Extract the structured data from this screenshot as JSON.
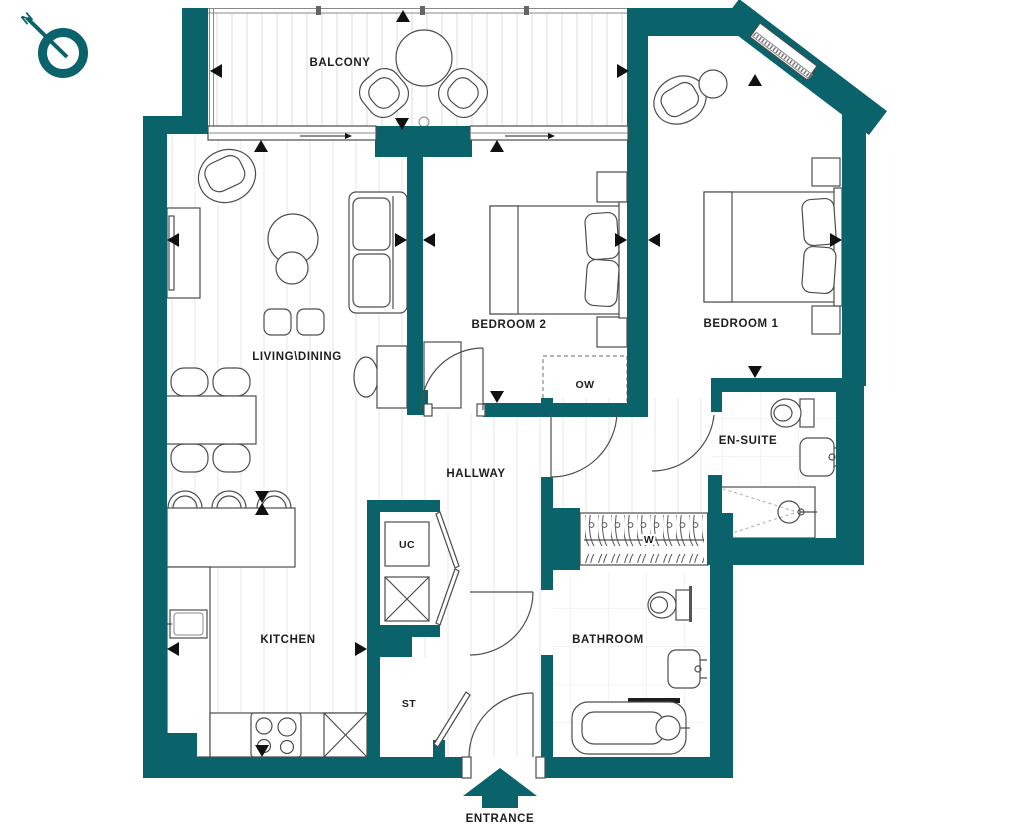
{
  "colors": {
    "wall": "#0a636b",
    "furniture_line": "#4d4d4d",
    "label": "#1e1e1e",
    "marker": "#111111"
  },
  "compass": {
    "north_label": "N"
  },
  "rooms": {
    "balcony": {
      "label": "BALCONY"
    },
    "living_dining": {
      "label": "LIVING\\DINING"
    },
    "bedroom2": {
      "label": "BEDROOM 2"
    },
    "bedroom1": {
      "label": "BEDROOM 1"
    },
    "ensuite": {
      "label": "EN-SUITE"
    },
    "hallway": {
      "label": "HALLWAY"
    },
    "kitchen": {
      "label": "KITCHEN"
    },
    "bathroom": {
      "label": "BATHROOM"
    }
  },
  "closets": {
    "open_wardrobe": {
      "label": "OW"
    },
    "utility_cupboard": {
      "label": "UC"
    },
    "storage": {
      "label": "ST"
    },
    "wardrobe": {
      "label": "W"
    }
  },
  "entrance": {
    "label": "ENTRANCE"
  }
}
